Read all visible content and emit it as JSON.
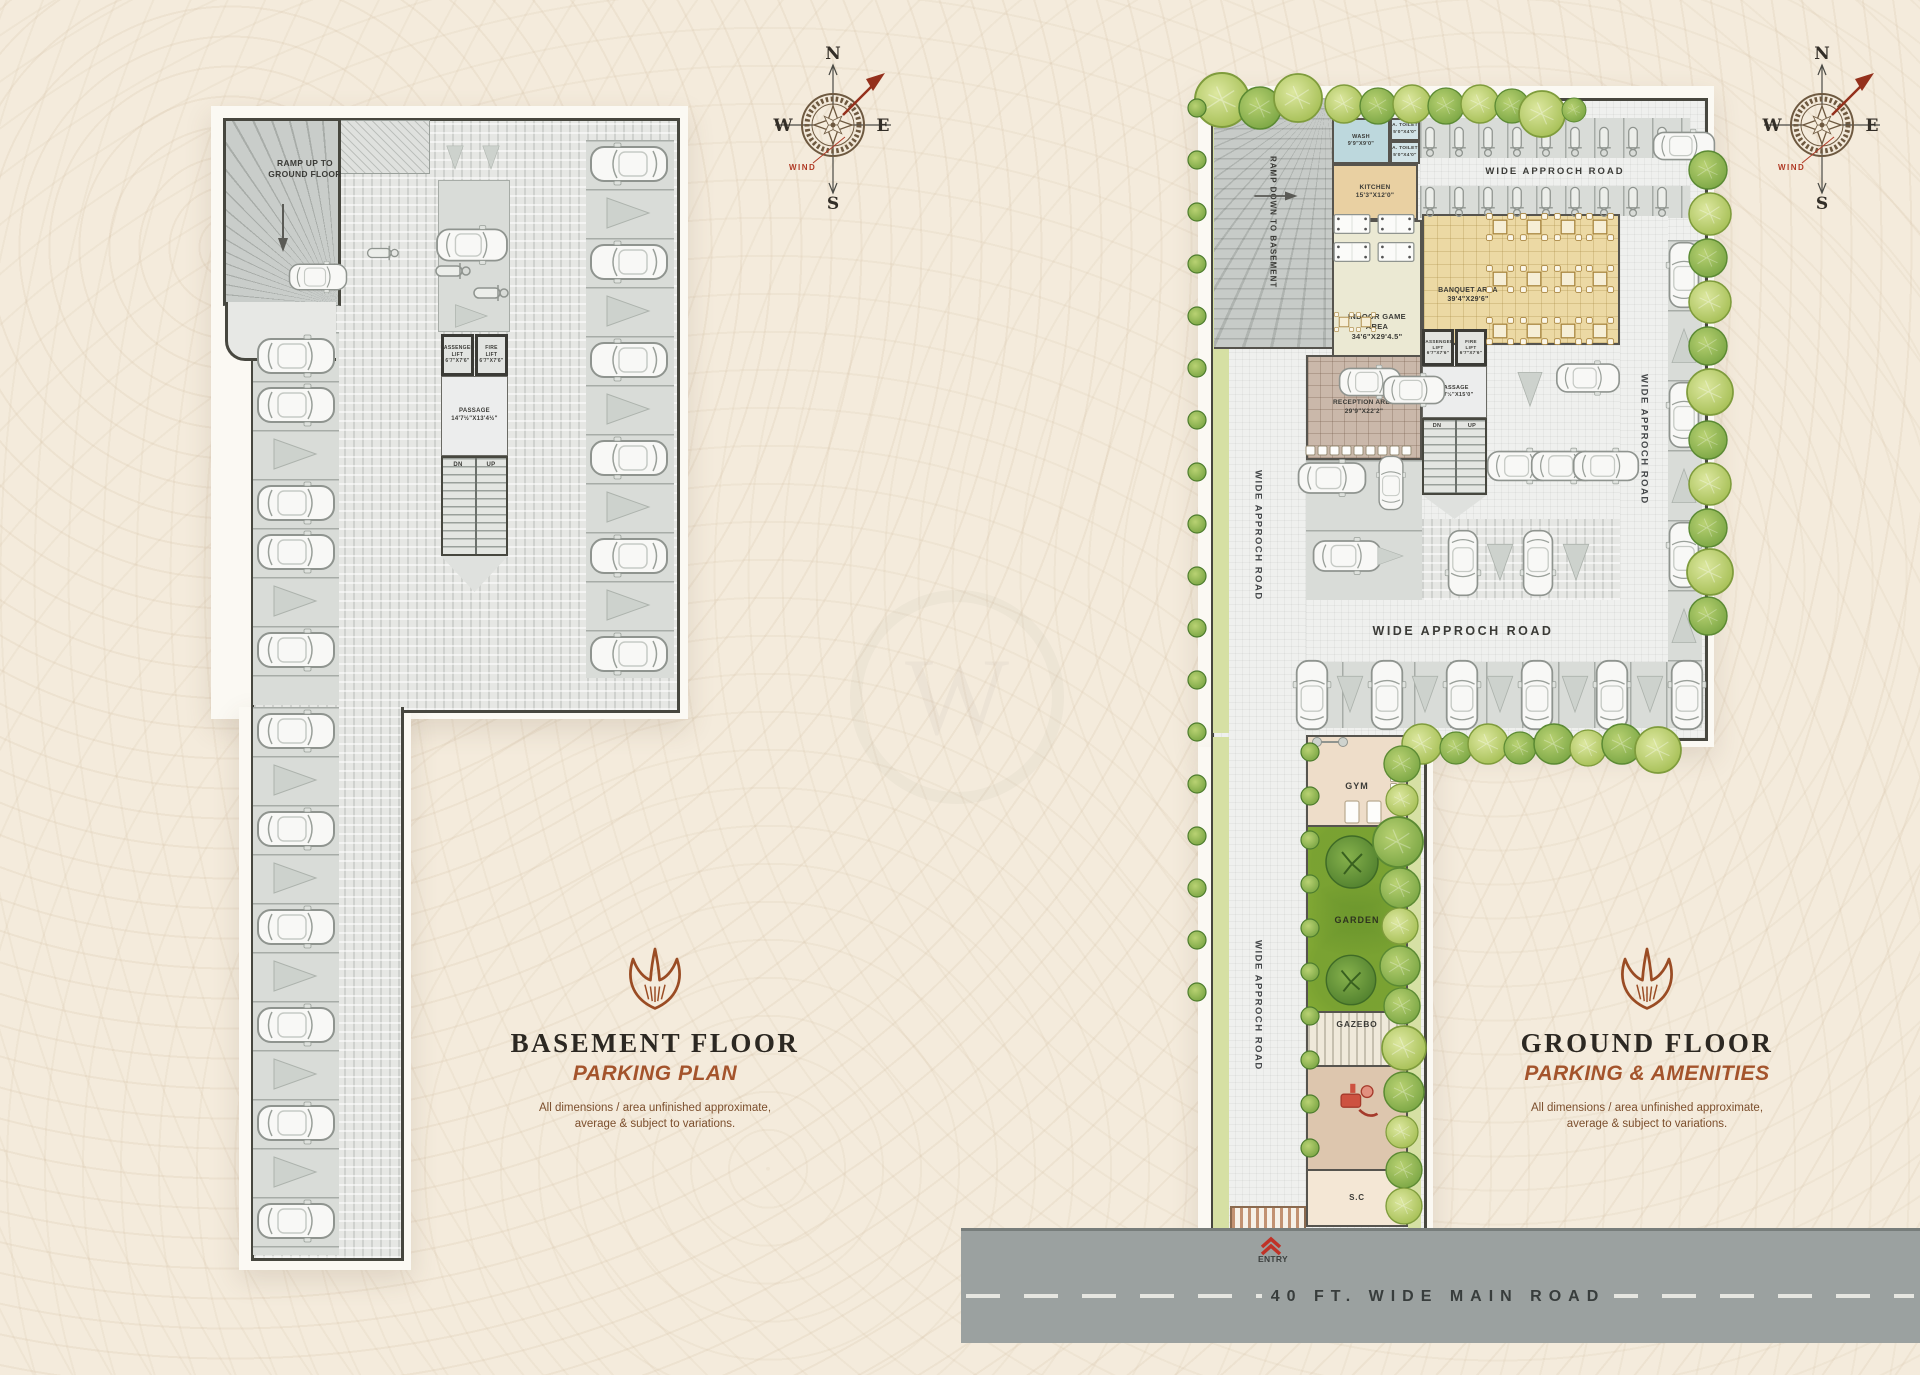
{
  "colors": {
    "page_bg": "#f4ebdc",
    "accent_brown": "#9a4c24",
    "title_dark": "#2c2822",
    "road_gray": "#9ba1a0",
    "garden_green": "#94b83a",
    "plan_border": "#47473f",
    "entry_red": "#c03227"
  },
  "compass": {
    "north": "N",
    "east": "E",
    "south": "S",
    "west": "W",
    "wind_label": "WIND"
  },
  "basement": {
    "ramp_label": "RAMP UP TO\nGROUND FLOOR",
    "passenger_lift": "PASSENGER\nLIFT\n6'7\"X7'6\"",
    "fire_lift": "FIRE\nLIFT\n6'7\"X7'6\"",
    "passage": "PASSAGE\n14'7½\"X13'4½\"",
    "stairs_dn": "DN",
    "stairs_up": "UP",
    "title": "BASEMENT FLOOR",
    "subtitle": "PARKING PLAN",
    "disclaimer": "All dimensions / area unfinished approximate,\naverage & subject to variations."
  },
  "ground": {
    "ramp_label": "RAMP DOWN TO BASEMENT",
    "wash": "WASH\n9'9\"X9'0\"",
    "toilet_a": "A. TOILET\n5'0\"X4'0\"",
    "toilet_b": "A. TOILET\n5'0\"X4'0\"",
    "kitchen": "KITCHEN\n15'3\"X12'0\"",
    "indoor_game": "INDOOR GAME AREA\n34'6\"X29'4.5\"",
    "banquet": "BANQUET AREA\n39'4\"X29'6\"",
    "passenger_lift": "PASSENGER\nLIFT\n6'7\"X7'6\"",
    "fire_lift": "FIRE\nLIFT\n6'7\"X7'6\"",
    "passage": "PASSAGE\n14'7½\"X15'0\"",
    "reception": "RECEPTION AREA\n29'9\"X22'2\"",
    "stairs_dn": "DN",
    "stairs_up": "UP",
    "road_top": "WIDE APPROCH ROAD",
    "road_left": "WIDE APPROCH ROAD",
    "road_right": "WIDE APPROCH ROAD",
    "road_mid": "WIDE APPROCH ROAD",
    "road_strip": "WIDE APPROCH ROAD",
    "gym": "GYM",
    "garden": "GARDEN",
    "gazebo": "GAZEBO",
    "sc": "S.C",
    "entry": "ENTRY",
    "main_road": "40 FT. WIDE MAIN ROAD",
    "title": "GROUND FLOOR",
    "subtitle": "PARKING & AMENITIES",
    "disclaimer": "All dimensions / area unfinished approximate,\naverage & subject to variations."
  },
  "sprites": [
    [
      "car",
      296,
      356,
      0,
      1
    ],
    [
      "car",
      296,
      405,
      0,
      1
    ],
    [
      "wedge",
      296,
      454,
      0,
      1
    ],
    [
      "car",
      296,
      503,
      0,
      1
    ],
    [
      "car",
      296,
      552,
      0,
      1
    ],
    [
      "wedge",
      296,
      601,
      0,
      1
    ],
    [
      "car",
      296,
      650,
      0,
      1
    ],
    [
      "car",
      296,
      731,
      0,
      1
    ],
    [
      "wedge",
      296,
      780,
      0,
      1
    ],
    [
      "car",
      296,
      829,
      0,
      1
    ],
    [
      "wedge",
      296,
      878,
      0,
      1
    ],
    [
      "car",
      296,
      927,
      0,
      1
    ],
    [
      "wedge",
      296,
      976,
      0,
      1
    ],
    [
      "car",
      296,
      1025,
      0,
      1
    ],
    [
      "wedge",
      296,
      1074,
      0,
      1
    ],
    [
      "car",
      296,
      1123,
      0,
      1
    ],
    [
      "wedge",
      296,
      1172,
      0,
      1
    ],
    [
      "car",
      296,
      1221,
      0,
      1
    ],
    [
      "car",
      629,
      164,
      180,
      1
    ],
    [
      "wedge",
      629,
      213,
      0,
      1
    ],
    [
      "car",
      629,
      262,
      180,
      1
    ],
    [
      "wedge",
      629,
      311,
      0,
      1
    ],
    [
      "car",
      629,
      360,
      180,
      1
    ],
    [
      "wedge",
      629,
      409,
      0,
      1
    ],
    [
      "car",
      629,
      458,
      180,
      1
    ],
    [
      "wedge",
      629,
      507,
      0,
      1
    ],
    [
      "car",
      629,
      556,
      180,
      1
    ],
    [
      "wedge",
      629,
      605,
      0,
      1
    ],
    [
      "car",
      629,
      654,
      180,
      1
    ],
    [
      "car",
      472,
      245,
      0,
      0.92
    ],
    [
      "scooter",
      452,
      271,
      0,
      1
    ],
    [
      "scooter",
      490,
      293,
      0,
      1
    ],
    [
      "wedge",
      472,
      316,
      0,
      0.75
    ],
    [
      "car",
      318,
      277,
      0,
      0.75
    ],
    [
      "scooter",
      382,
      253,
      0,
      0.9
    ],
    [
      "wedge",
      455,
      158,
      90,
      0.55
    ],
    [
      "wedge",
      491,
      158,
      90,
      0.55
    ],
    [
      "arrowd",
      283,
      228,
      0,
      1
    ],
    [
      "arrowd",
      1276,
      196,
      270,
      0.9
    ],
    [
      "scooter",
      1430,
      141,
      90,
      0.85
    ],
    [
      "scooter",
      1459,
      141,
      90,
      0.85
    ],
    [
      "scooter",
      1488,
      141,
      90,
      0.85
    ],
    [
      "scooter",
      1517,
      141,
      90,
      0.85
    ],
    [
      "scooter",
      1546,
      141,
      90,
      0.85
    ],
    [
      "scooter",
      1575,
      141,
      90,
      0.85
    ],
    [
      "scooter",
      1604,
      141,
      90,
      0.85
    ],
    [
      "scooter",
      1633,
      141,
      90,
      0.85
    ],
    [
      "scooter",
      1662,
      141,
      90,
      0.85
    ],
    [
      "scooter",
      1430,
      201,
      90,
      0.85
    ],
    [
      "scooter",
      1459,
      201,
      90,
      0.85
    ],
    [
      "scooter",
      1488,
      201,
      90,
      0.85
    ],
    [
      "scooter",
      1517,
      201,
      90,
      0.85
    ],
    [
      "scooter",
      1546,
      201,
      90,
      0.85
    ],
    [
      "scooter",
      1575,
      201,
      90,
      0.85
    ],
    [
      "scooter",
      1604,
      201,
      90,
      0.85
    ],
    [
      "scooter",
      1633,
      201,
      90,
      0.85
    ],
    [
      "scooter",
      1662,
      201,
      90,
      0.85
    ],
    [
      "car",
      1684,
      146,
      0,
      0.8
    ],
    [
      "table4",
      1500,
      227,
      0,
      0.85
    ],
    [
      "table4",
      1534,
      227,
      0,
      0.85
    ],
    [
      "table4",
      1568,
      227,
      0,
      0.85
    ],
    [
      "table4",
      1600,
      227,
      0,
      0.85
    ],
    [
      "table4",
      1500,
      279,
      0,
      0.85
    ],
    [
      "table4",
      1534,
      279,
      0,
      0.85
    ],
    [
      "table4",
      1568,
      279,
      0,
      0.85
    ],
    [
      "table4",
      1600,
      279,
      0,
      0.85
    ],
    [
      "table4",
      1500,
      331,
      0,
      0.85
    ],
    [
      "table4",
      1534,
      331,
      0,
      0.85
    ],
    [
      "table4",
      1568,
      331,
      0,
      0.85
    ],
    [
      "table4",
      1600,
      331,
      0,
      0.85
    ],
    [
      "pool",
      1352,
      224,
      0,
      0.85
    ],
    [
      "pool",
      1396,
      224,
      0,
      0.85
    ],
    [
      "pool",
      1352,
      252,
      0,
      0.85
    ],
    [
      "pool",
      1396,
      252,
      0,
      0.85
    ],
    [
      "table4",
      1344,
      322,
      0,
      0.6
    ],
    [
      "table4",
      1366,
      322,
      0,
      0.6
    ],
    [
      "seats",
      1322,
      450,
      0,
      1
    ],
    [
      "seats",
      1358,
      450,
      0,
      1
    ],
    [
      "seats",
      1394,
      450,
      0,
      1
    ],
    [
      "car",
      1332,
      478,
      0,
      0.88
    ],
    [
      "car",
      1391,
      483,
      270,
      0.7
    ],
    [
      "car",
      1347,
      556,
      0,
      0.88
    ],
    [
      "wedge",
      1391,
      556,
      0,
      0.6
    ],
    [
      "car",
      1520,
      466,
      0,
      0.85
    ],
    [
      "car",
      1564,
      466,
      0,
      0.85
    ],
    [
      "car",
      1606,
      466,
      0,
      0.85
    ],
    [
      "car",
      1463,
      563,
      90,
      0.85
    ],
    [
      "wedge",
      1500,
      563,
      90,
      0.85
    ],
    [
      "car",
      1538,
      563,
      90,
      0.85
    ],
    [
      "wedge",
      1576,
      563,
      90,
      0.85
    ],
    [
      "car",
      1588,
      378,
      0,
      0.82
    ],
    [
      "car",
      1370,
      382,
      0,
      0.8
    ],
    [
      "car",
      1414,
      390,
      0,
      0.8
    ],
    [
      "wedge",
      1530,
      390,
      90,
      0.8
    ],
    [
      "car",
      1312,
      695,
      270,
      0.9
    ],
    [
      "wedge",
      1350,
      695,
      90,
      0.85
    ],
    [
      "car",
      1387,
      695,
      270,
      0.9
    ],
    [
      "wedge",
      1425,
      695,
      90,
      0.85
    ],
    [
      "car",
      1462,
      695,
      270,
      0.9
    ],
    [
      "wedge",
      1500,
      695,
      90,
      0.85
    ],
    [
      "car",
      1537,
      695,
      270,
      0.9
    ],
    [
      "wedge",
      1575,
      695,
      90,
      0.85
    ],
    [
      "car",
      1612,
      695,
      270,
      0.9
    ],
    [
      "wedge",
      1650,
      695,
      90,
      0.85
    ],
    [
      "car",
      1687,
      695,
      270,
      0.9
    ],
    [
      "car",
      1684,
      275,
      270,
      0.85
    ],
    [
      "wedge",
      1684,
      345,
      270,
      0.8
    ],
    [
      "car",
      1684,
      415,
      270,
      0.85
    ],
    [
      "wedge",
      1684,
      485,
      270,
      0.8
    ],
    [
      "car",
      1684,
      555,
      270,
      0.85
    ],
    [
      "wedge",
      1684,
      625,
      270,
      0.8
    ],
    [
      "barbell",
      1330,
      742,
      0,
      1
    ],
    [
      "mat",
      1352,
      812,
      0,
      1
    ],
    [
      "mat",
      1374,
      812,
      0,
      1
    ],
    [
      "seats",
      1394,
      778,
      90,
      0.7
    ],
    [
      "play",
      1358,
      1102,
      0,
      1.3
    ],
    [
      "chev",
      1271,
      1243,
      0,
      1
    ],
    [
      "gtree",
      1352,
      862,
      0,
      1
    ],
    [
      "gtree",
      1351,
      980,
      0,
      0.95
    ],
    [
      "tree1",
      1222,
      100,
      0,
      1.35
    ],
    [
      "tree2",
      1260,
      108,
      0,
      1.05
    ],
    [
      "tree1",
      1298,
      98,
      0,
      1.2
    ],
    [
      "tree1",
      1344,
      104,
      0,
      0.95
    ],
    [
      "tree2",
      1378,
      106,
      0,
      0.9
    ],
    [
      "tree1",
      1412,
      104,
      0,
      0.95
    ],
    [
      "tree2",
      1446,
      106,
      0,
      0.9
    ],
    [
      "tree1",
      1480,
      104,
      0,
      0.95
    ],
    [
      "tree2",
      1512,
      106,
      0,
      0.85
    ],
    [
      "tree1",
      1542,
      114,
      0,
      1.15
    ],
    [
      "tree2",
      1574,
      110,
      0,
      0.6
    ],
    [
      "tree2",
      1708,
      170,
      0,
      0.95
    ],
    [
      "tree1",
      1710,
      214,
      0,
      1.05
    ],
    [
      "tree2",
      1708,
      258,
      0,
      0.95
    ],
    [
      "tree1",
      1710,
      302,
      0,
      1.05
    ],
    [
      "tree2",
      1708,
      346,
      0,
      0.95
    ],
    [
      "tree1",
      1710,
      392,
      0,
      1.15
    ],
    [
      "tree2",
      1708,
      440,
      0,
      0.95
    ],
    [
      "tree1",
      1710,
      484,
      0,
      1.05
    ],
    [
      "tree2",
      1708,
      528,
      0,
      0.95
    ],
    [
      "tree1",
      1710,
      572,
      0,
      1.15
    ],
    [
      "tree2",
      1708,
      616,
      0,
      0.95
    ],
    [
      "tree1",
      1422,
      744,
      0,
      1
    ],
    [
      "tree2",
      1456,
      748,
      0,
      0.8
    ],
    [
      "tree1",
      1488,
      744,
      0,
      1
    ],
    [
      "tree2",
      1520,
      748,
      0,
      0.8
    ],
    [
      "tree2",
      1554,
      744,
      0,
      1
    ],
    [
      "tree1",
      1588,
      748,
      0,
      0.9
    ],
    [
      "tree2",
      1622,
      744,
      0,
      1
    ],
    [
      "tree1",
      1658,
      750,
      0,
      1.15
    ],
    [
      "bush",
      1197,
      108,
      0,
      1
    ],
    [
      "bush",
      1197,
      160,
      0,
      1
    ],
    [
      "bush",
      1197,
      212,
      0,
      1
    ],
    [
      "bush",
      1197,
      264,
      0,
      1
    ],
    [
      "bush",
      1197,
      316,
      0,
      1
    ],
    [
      "bush",
      1197,
      368,
      0,
      1
    ],
    [
      "bush",
      1197,
      420,
      0,
      1
    ],
    [
      "bush",
      1197,
      472,
      0,
      1
    ],
    [
      "bush",
      1197,
      524,
      0,
      1
    ],
    [
      "bush",
      1197,
      576,
      0,
      1
    ],
    [
      "bush",
      1197,
      628,
      0,
      1
    ],
    [
      "bush",
      1197,
      680,
      0,
      1
    ],
    [
      "bush",
      1197,
      732,
      0,
      1
    ],
    [
      "bush",
      1197,
      784,
      0,
      1
    ],
    [
      "bush",
      1197,
      836,
      0,
      1
    ],
    [
      "bush",
      1197,
      888,
      0,
      1
    ],
    [
      "bush",
      1197,
      940,
      0,
      1
    ],
    [
      "bush",
      1197,
      992,
      0,
      1
    ],
    [
      "tree2",
      1402,
      764,
      0,
      0.9
    ],
    [
      "tree1",
      1402,
      800,
      0,
      0.8
    ],
    [
      "tree2",
      1398,
      842,
      0,
      1.25
    ],
    [
      "tree2",
      1400,
      888,
      0,
      1
    ],
    [
      "tree1",
      1400,
      926,
      0,
      0.9
    ],
    [
      "tree2",
      1400,
      966,
      0,
      1
    ],
    [
      "tree2",
      1402,
      1006,
      0,
      0.9
    ],
    [
      "tree1",
      1404,
      1048,
      0,
      1.1
    ],
    [
      "tree2",
      1404,
      1092,
      0,
      1
    ],
    [
      "tree1",
      1402,
      1132,
      0,
      0.8
    ],
    [
      "tree2",
      1404,
      1170,
      0,
      0.9
    ],
    [
      "tree1",
      1404,
      1206,
      0,
      0.9
    ],
    [
      "bush",
      1310,
      752,
      0,
      1
    ],
    [
      "bush",
      1310,
      796,
      0,
      1
    ],
    [
      "bush",
      1310,
      840,
      0,
      1
    ],
    [
      "bush",
      1310,
      884,
      0,
      1
    ],
    [
      "bush",
      1310,
      928,
      0,
      1
    ],
    [
      "bush",
      1310,
      972,
      0,
      1
    ],
    [
      "bush",
      1310,
      1016,
      0,
      1
    ],
    [
      "bush",
      1310,
      1060,
      0,
      1
    ],
    [
      "bush",
      1310,
      1104,
      0,
      1
    ],
    [
      "bush",
      1310,
      1148,
      0,
      1
    ]
  ]
}
